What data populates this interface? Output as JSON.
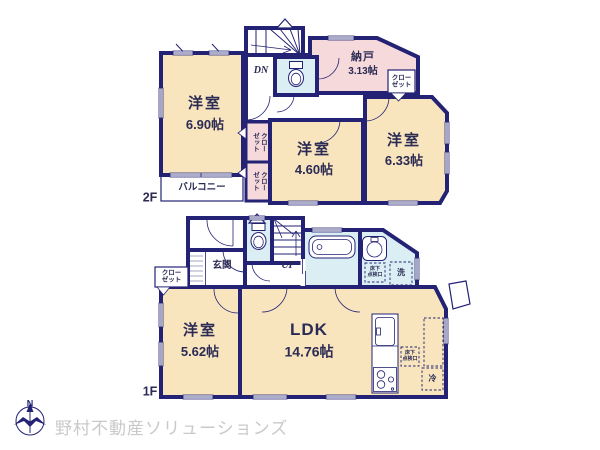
{
  "colors": {
    "wall": "#232274",
    "beige": "#f8e5bd",
    "pink": "#f6d9da",
    "cyan": "#daeef3",
    "room_text": "#2b2b55",
    "logo_gray": "#c9c9c9"
  },
  "logo": {
    "compass_n": "N",
    "company": "野村不動産ソリューションズ"
  },
  "floor2": {
    "label": "2F",
    "stairs": "DN",
    "room690": {
      "name": "洋室",
      "size": "6.90帖"
    },
    "room460": {
      "name": "洋室",
      "size": "4.60帖"
    },
    "room633": {
      "name": "洋室",
      "size": "6.33帖"
    },
    "nando": {
      "name": "納戸",
      "size": "3.13帖"
    },
    "closet_right": {
      "line1": "クロー",
      "line2": "ゼット"
    },
    "closet_a": {
      "line1": "クロー",
      "line2": "ゼット"
    },
    "closet_b": {
      "line1": "クロー",
      "line2": "ゼット"
    },
    "balcony": "バルコニー"
  },
  "floor1": {
    "label": "1F",
    "stairs": "UP",
    "genkan": "玄関",
    "closet": {
      "line1": "クロー",
      "line2": "ゼット"
    },
    "room562": {
      "name": "洋室",
      "size": "5.62帖"
    },
    "ldk": {
      "name": "LDK",
      "size": "14.76帖"
    },
    "laundry": "洗",
    "fridge": "冷",
    "hatch_washroom": {
      "line1": "床下",
      "line2": "点検口"
    },
    "hatch_ldk": {
      "line1": "床下",
      "line2": "点検口"
    }
  }
}
